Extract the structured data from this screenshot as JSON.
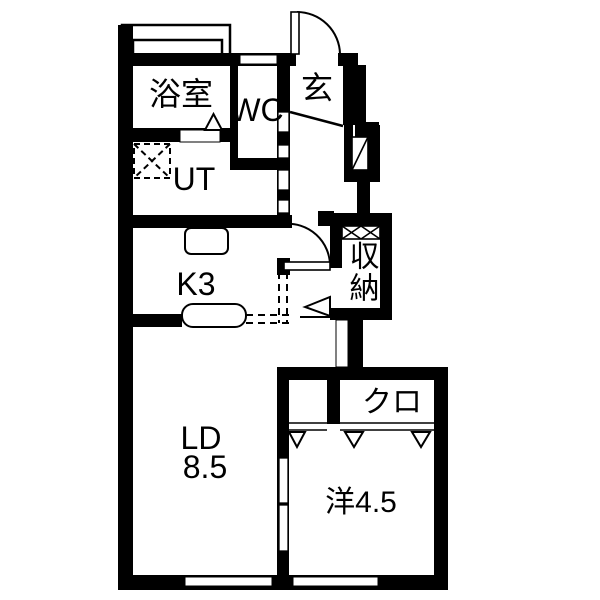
{
  "title": "apartment-floor-plan",
  "colors": {
    "wall": "#000000",
    "background": "#ffffff",
    "line": "#000000"
  },
  "rooms": {
    "bathroom": {
      "label": "浴室"
    },
    "wc": {
      "label": "WC"
    },
    "entrance": {
      "label": "玄"
    },
    "utility": {
      "label": "UT"
    },
    "kitchen": {
      "label": "K3"
    },
    "living_dining": {
      "label": "LD",
      "size": "8.5"
    },
    "storage": {
      "label": "収納"
    },
    "closet": {
      "label": "クロ"
    },
    "western_room": {
      "label": "洋4.5"
    }
  }
}
